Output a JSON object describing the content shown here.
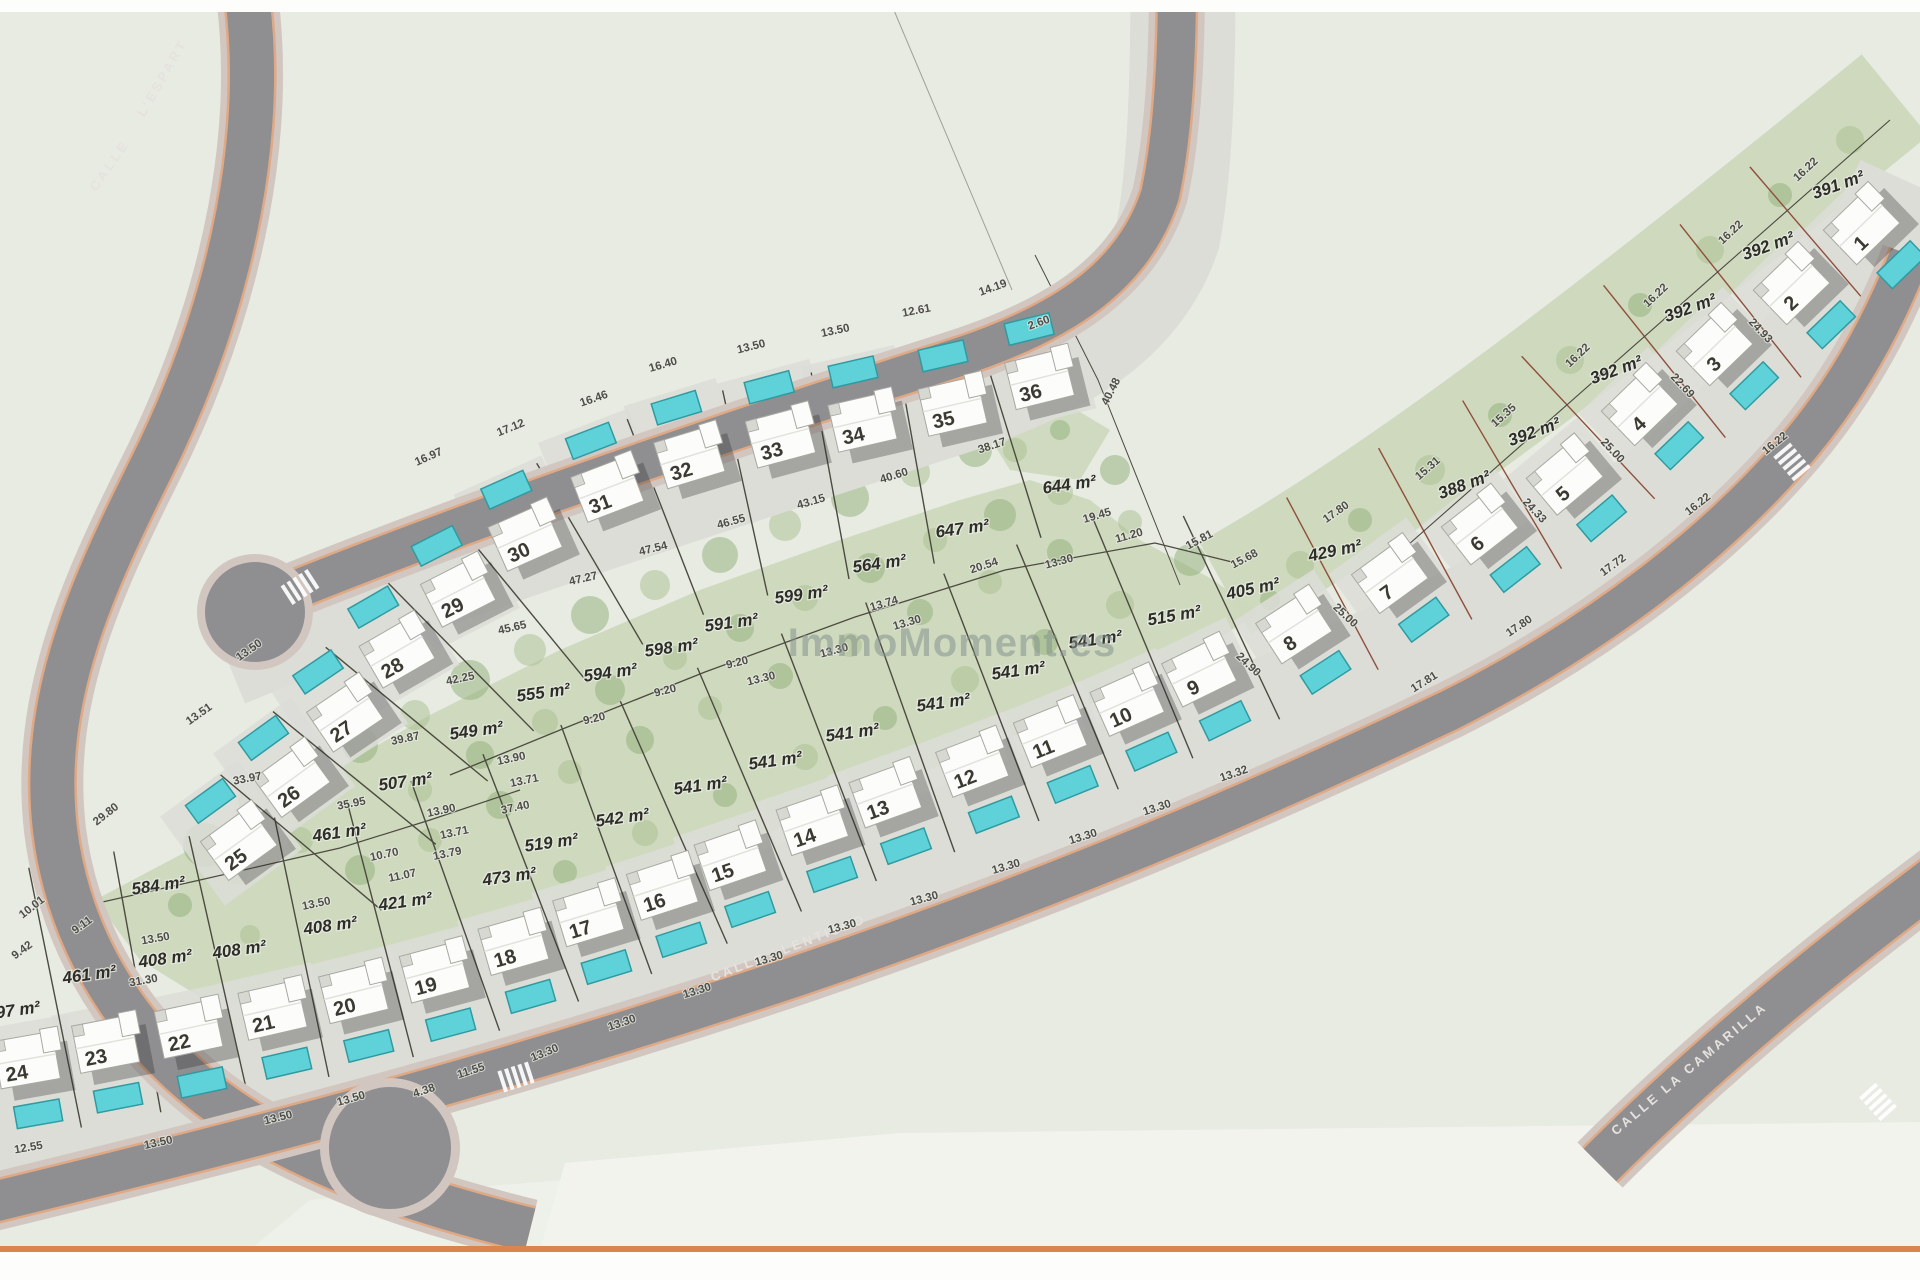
{
  "watermark": "ImmoMoment.es",
  "colors": {
    "page": "#fdfdfb",
    "field": "#e7ebe2",
    "light_zone": "#f1f3ec",
    "garden": "#ccd8bc",
    "tree1": "#a9c08f",
    "tree2": "#8fb077",
    "pavement": "#dcddd7",
    "asphalt": "#8f8e91",
    "sidewalk": "#d2c6c0",
    "curb": "#e2a176",
    "pool": "#5ed2d8",
    "pool_border": "#2f9ba1",
    "house": "#fcfcfa",
    "house_border": "#a8a8a2",
    "line_dark": "#4c4b40",
    "line_red": "#8f4f3c",
    "dim_text": "#4e4d48",
    "area_text": "#2e2d28",
    "num_text": "#3a3932",
    "watermark": "#87938e",
    "road_text": "#e6e2de",
    "orange_bar": "#d8854e"
  },
  "road_labels": [
    {
      "t": "CALLE",
      "x": 113,
      "y": 168,
      "r": -55
    },
    {
      "t": "L'ESPART",
      "x": 166,
      "y": 80,
      "r": -60
    },
    {
      "t": "CALLE LLENTISCO",
      "x": 790,
      "y": 952,
      "r": -21
    },
    {
      "t": "CALLE LA CAMARILLA",
      "x": 1692,
      "y": 1072,
      "r": -40
    }
  ],
  "plots": [
    {
      "n": "1",
      "x": 1845,
      "y": 242,
      "r": -44,
      "pool": "S"
    },
    {
      "n": "2",
      "x": 1775,
      "y": 302,
      "r": -44,
      "pool": "S"
    },
    {
      "n": "3",
      "x": 1698,
      "y": 363,
      "r": -44,
      "pool": "S"
    },
    {
      "n": "4",
      "x": 1623,
      "y": 423,
      "r": -44,
      "pool": "S"
    },
    {
      "n": "5",
      "x": 1548,
      "y": 493,
      "r": -40,
      "pool": "S"
    },
    {
      "n": "6",
      "x": 1463,
      "y": 543,
      "r": -38,
      "pool": "S"
    },
    {
      "n": "7",
      "x": 1373,
      "y": 592,
      "r": -36,
      "pool": "S"
    },
    {
      "n": "8",
      "x": 1277,
      "y": 643,
      "r": -33,
      "pool": "S"
    },
    {
      "n": "9",
      "x": 1182,
      "y": 688,
      "r": -26,
      "pool": "S"
    },
    {
      "n": "10",
      "x": 1110,
      "y": 718,
      "r": -24,
      "pool": "S"
    },
    {
      "n": "11",
      "x": 1033,
      "y": 750,
      "r": -22,
      "pool": "S"
    },
    {
      "n": "12",
      "x": 955,
      "y": 780,
      "r": -21,
      "pool": "S"
    },
    {
      "n": "13",
      "x": 868,
      "y": 811,
      "r": -20,
      "pool": "S"
    },
    {
      "n": "14",
      "x": 795,
      "y": 839,
      "r": -19,
      "pool": "S"
    },
    {
      "n": "15",
      "x": 713,
      "y": 874,
      "r": -19,
      "pool": "S"
    },
    {
      "n": "16",
      "x": 645,
      "y": 904,
      "r": -18,
      "pool": "S"
    },
    {
      "n": "17",
      "x": 571,
      "y": 931,
      "r": -17,
      "pool": "S"
    },
    {
      "n": "18",
      "x": 496,
      "y": 960,
      "r": -16,
      "pool": "S"
    },
    {
      "n": "19",
      "x": 417,
      "y": 988,
      "r": -15,
      "pool": "S"
    },
    {
      "n": "20",
      "x": 336,
      "y": 1009,
      "r": -14,
      "pool": "S"
    },
    {
      "n": "21",
      "x": 255,
      "y": 1026,
      "r": -13,
      "pool": "S"
    },
    {
      "n": "22",
      "x": 171,
      "y": 1045,
      "r": -12,
      "pool": "S"
    },
    {
      "n": "23",
      "x": 88,
      "y": 1060,
      "r": -11,
      "pool": "S"
    },
    {
      "n": "24",
      "x": 9,
      "y": 1076,
      "r": -10,
      "pool": "S"
    },
    {
      "n": "25",
      "x": 222,
      "y": 859,
      "r": -36,
      "pool": "N"
    },
    {
      "n": "26",
      "x": 275,
      "y": 796,
      "r": -36,
      "pool": "N"
    },
    {
      "n": "27",
      "x": 328,
      "y": 731,
      "r": -34,
      "pool": "N"
    },
    {
      "n": "28",
      "x": 380,
      "y": 668,
      "r": -30,
      "pool": "N"
    },
    {
      "n": "29",
      "x": 441,
      "y": 608,
      "r": -27,
      "pool": "N"
    },
    {
      "n": "30",
      "x": 508,
      "y": 553,
      "r": -24,
      "pool": "N"
    },
    {
      "n": "31",
      "x": 590,
      "y": 505,
      "r": -21,
      "pool": "N"
    },
    {
      "n": "32",
      "x": 672,
      "y": 473,
      "r": -17,
      "pool": "N"
    },
    {
      "n": "33",
      "x": 763,
      "y": 453,
      "r": -15,
      "pool": "N"
    },
    {
      "n": "34",
      "x": 845,
      "y": 438,
      "r": -13,
      "pool": "N"
    },
    {
      "n": "35",
      "x": 935,
      "y": 422,
      "r": -13,
      "pool": "N"
    },
    {
      "n": "36",
      "x": 1022,
      "y": 395,
      "r": -14,
      "pool": "N"
    }
  ],
  "area_labels": [
    {
      "t": "391 m²",
      "x": 1840,
      "y": 190,
      "r": -20
    },
    {
      "t": "392 m²",
      "x": 1770,
      "y": 251,
      "r": -20
    },
    {
      "t": "392 m²",
      "x": 1692,
      "y": 313,
      "r": -20
    },
    {
      "t": "392 m²",
      "x": 1618,
      "y": 375,
      "r": -20
    },
    {
      "t": "392 m²",
      "x": 1536,
      "y": 437,
      "r": -20
    },
    {
      "t": "388 m²",
      "x": 1466,
      "y": 490,
      "r": -20
    },
    {
      "t": "429 m²",
      "x": 1336,
      "y": 556,
      "r": -12
    },
    {
      "t": "405 m²",
      "x": 1254,
      "y": 594,
      "r": -12
    },
    {
      "t": "515 m²",
      "x": 1175,
      "y": 621,
      "r": -10
    },
    {
      "t": "541 m²",
      "x": 1096,
      "y": 645,
      "r": -8
    },
    {
      "t": "541 m²",
      "x": 1019,
      "y": 676,
      "r": -8
    },
    {
      "t": "541 m²",
      "x": 944,
      "y": 708,
      "r": -8
    },
    {
      "t": "541 m²",
      "x": 853,
      "y": 738,
      "r": -8
    },
    {
      "t": "541 m²",
      "x": 776,
      "y": 766,
      "r": -8
    },
    {
      "t": "541 m²",
      "x": 701,
      "y": 791,
      "r": -8
    },
    {
      "t": "542 m²",
      "x": 623,
      "y": 823,
      "r": -8
    },
    {
      "t": "519 m²",
      "x": 552,
      "y": 848,
      "r": -8
    },
    {
      "t": "473 m²",
      "x": 510,
      "y": 882,
      "r": -8
    },
    {
      "t": "421 m²",
      "x": 406,
      "y": 907,
      "r": -8
    },
    {
      "t": "408 m²",
      "x": 331,
      "y": 931,
      "r": -8
    },
    {
      "t": "408 m²",
      "x": 240,
      "y": 955,
      "r": -8
    },
    {
      "t": "408 m²",
      "x": 166,
      "y": 964,
      "r": -8
    },
    {
      "t": "461 m²",
      "x": 90,
      "y": 980,
      "r": -8
    },
    {
      "t": "397 m²",
      "x": 14,
      "y": 1016,
      "r": -8
    },
    {
      "t": "584 m²",
      "x": 159,
      "y": 891,
      "r": -8
    },
    {
      "t": "461 m²",
      "x": 340,
      "y": 838,
      "r": -8
    },
    {
      "t": "507 m²",
      "x": 406,
      "y": 787,
      "r": -8
    },
    {
      "t": "549 m²",
      "x": 477,
      "y": 736,
      "r": -8
    },
    {
      "t": "555 m²",
      "x": 544,
      "y": 698,
      "r": -8
    },
    {
      "t": "594 m²",
      "x": 611,
      "y": 678,
      "r": -8
    },
    {
      "t": "598 m²",
      "x": 672,
      "y": 653,
      "r": -8
    },
    {
      "t": "591 m²",
      "x": 732,
      "y": 628,
      "r": -8
    },
    {
      "t": "599 m²",
      "x": 802,
      "y": 600,
      "r": -8
    },
    {
      "t": "564 m²",
      "x": 880,
      "y": 569,
      "r": -8
    },
    {
      "t": "647 m²",
      "x": 963,
      "y": 534,
      "r": -8
    },
    {
      "t": "644 m²",
      "x": 1070,
      "y": 490,
      "r": -8
    }
  ],
  "dim_labels": [
    {
      "t": "16.97",
      "x": 430,
      "y": 460,
      "r": -24
    },
    {
      "t": "17.12",
      "x": 512,
      "y": 431,
      "r": -22
    },
    {
      "t": "16.46",
      "x": 595,
      "y": 402,
      "r": -19
    },
    {
      "t": "16.40",
      "x": 664,
      "y": 368,
      "r": -16
    },
    {
      "t": "13.50",
      "x": 752,
      "y": 350,
      "r": -14
    },
    {
      "t": "13.50",
      "x": 836,
      "y": 334,
      "r": -12
    },
    {
      "t": "12.61",
      "x": 917,
      "y": 314,
      "r": -11
    },
    {
      "t": "14.19",
      "x": 994,
      "y": 291,
      "r": -20
    },
    {
      "t": "13.50",
      "x": 251,
      "y": 653,
      "r": -35
    },
    {
      "t": "13.51",
      "x": 201,
      "y": 717,
      "r": -35
    },
    {
      "t": "29.80",
      "x": 108,
      "y": 817,
      "r": -38
    },
    {
      "t": "10.01",
      "x": 34,
      "y": 910,
      "r": -38
    },
    {
      "t": "9.11",
      "x": 84,
      "y": 928,
      "r": -36
    },
    {
      "t": "9.42",
      "x": 24,
      "y": 953,
      "r": -36
    },
    {
      "t": "13.50",
      "x": 317,
      "y": 907,
      "r": -12
    },
    {
      "t": "13.50",
      "x": 156,
      "y": 942,
      "r": -10
    },
    {
      "t": "31.30",
      "x": 144,
      "y": 984,
      "r": -10
    },
    {
      "t": "12.55",
      "x": 29,
      "y": 1151,
      "r": -10
    },
    {
      "t": "13.50",
      "x": 159,
      "y": 1146,
      "r": -12
    },
    {
      "t": "13.50",
      "x": 279,
      "y": 1121,
      "r": -14
    },
    {
      "t": "13.50",
      "x": 352,
      "y": 1102,
      "r": -16
    },
    {
      "t": "11.55",
      "x": 472,
      "y": 1074,
      "r": -18
    },
    {
      "t": "4.38",
      "x": 425,
      "y": 1094,
      "r": -18
    },
    {
      "t": "13.30",
      "x": 546,
      "y": 1056,
      "r": -22
    },
    {
      "t": "13.30",
      "x": 623,
      "y": 1026,
      "r": -19
    },
    {
      "t": "13.30",
      "x": 698,
      "y": 994,
      "r": -17
    },
    {
      "t": "13.30",
      "x": 770,
      "y": 962,
      "r": -16
    },
    {
      "t": "13.30",
      "x": 843,
      "y": 930,
      "r": -15
    },
    {
      "t": "13.30",
      "x": 925,
      "y": 902,
      "r": -15
    },
    {
      "t": "13.30",
      "x": 1007,
      "y": 870,
      "r": -16
    },
    {
      "t": "13.30",
      "x": 1084,
      "y": 840,
      "r": -17
    },
    {
      "t": "13.30",
      "x": 1158,
      "y": 811,
      "r": -18
    },
    {
      "t": "13.32",
      "x": 1235,
      "y": 777,
      "r": -19
    },
    {
      "t": "17.81",
      "x": 1426,
      "y": 685,
      "r": -32
    },
    {
      "t": "17.80",
      "x": 1521,
      "y": 629,
      "r": -34
    },
    {
      "t": "17.72",
      "x": 1615,
      "y": 568,
      "r": -36
    },
    {
      "t": "16.22",
      "x": 1700,
      "y": 507,
      "r": -38
    },
    {
      "t": "16.22",
      "x": 1777,
      "y": 446,
      "r": -39
    },
    {
      "t": "16.22",
      "x": 1808,
      "y": 172,
      "r": -43
    },
    {
      "t": "16.22",
      "x": 1733,
      "y": 235,
      "r": -43
    },
    {
      "t": "16.22",
      "x": 1658,
      "y": 298,
      "r": -43
    },
    {
      "t": "16.22",
      "x": 1580,
      "y": 358,
      "r": -43
    },
    {
      "t": "15.35",
      "x": 1506,
      "y": 418,
      "r": -42
    },
    {
      "t": "15.31",
      "x": 1430,
      "y": 471,
      "r": -41
    },
    {
      "t": "24.93",
      "x": 1758,
      "y": 333,
      "r": 47
    },
    {
      "t": "22.69",
      "x": 1680,
      "y": 388,
      "r": 47
    },
    {
      "t": "25.00",
      "x": 1610,
      "y": 453,
      "r": 47
    },
    {
      "t": "24.33",
      "x": 1532,
      "y": 513,
      "r": 47
    },
    {
      "t": "25.00",
      "x": 1343,
      "y": 618,
      "r": 43
    },
    {
      "t": "24.90",
      "x": 1246,
      "y": 667,
      "r": 43
    },
    {
      "t": "17.80",
      "x": 1338,
      "y": 515,
      "r": -35
    },
    {
      "t": "40.48",
      "x": 1114,
      "y": 393,
      "r": -63
    },
    {
      "t": "2.60",
      "x": 1040,
      "y": 326,
      "r": -20
    },
    {
      "t": "19.45",
      "x": 1098,
      "y": 519,
      "r": -16
    },
    {
      "t": "11.20",
      "x": 1130,
      "y": 539,
      "r": -16
    },
    {
      "t": "13.30",
      "x": 1060,
      "y": 565,
      "r": -15
    },
    {
      "t": "15.81",
      "x": 1201,
      "y": 543,
      "r": -28
    },
    {
      "t": "15.68",
      "x": 1246,
      "y": 562,
      "r": -28
    },
    {
      "t": "20.54",
      "x": 985,
      "y": 569,
      "r": -18
    },
    {
      "t": "13.74",
      "x": 885,
      "y": 607,
      "r": -16
    },
    {
      "t": "13.30",
      "x": 908,
      "y": 626,
      "r": -16
    },
    {
      "t": "13.30",
      "x": 835,
      "y": 654,
      "r": -15
    },
    {
      "t": "13.30",
      "x": 762,
      "y": 682,
      "r": -14
    },
    {
      "t": "9.20",
      "x": 738,
      "y": 666,
      "r": -14
    },
    {
      "t": "9.20",
      "x": 666,
      "y": 694,
      "r": -14
    },
    {
      "t": "9.20",
      "x": 595,
      "y": 722,
      "r": -13
    },
    {
      "t": "38.17",
      "x": 993,
      "y": 449,
      "r": -18
    },
    {
      "t": "40.60",
      "x": 895,
      "y": 479,
      "r": -17
    },
    {
      "t": "43.15",
      "x": 812,
      "y": 505,
      "r": -16
    },
    {
      "t": "46.55",
      "x": 732,
      "y": 525,
      "r": -15
    },
    {
      "t": "47.54",
      "x": 654,
      "y": 552,
      "r": -14
    },
    {
      "t": "47.27",
      "x": 584,
      "y": 582,
      "r": -13
    },
    {
      "t": "45.65",
      "x": 513,
      "y": 631,
      "r": -13
    },
    {
      "t": "42.25",
      "x": 461,
      "y": 682,
      "r": -12
    },
    {
      "t": "39.87",
      "x": 406,
      "y": 742,
      "r": -12
    },
    {
      "t": "35.95",
      "x": 352,
      "y": 807,
      "r": -11
    },
    {
      "t": "33.97",
      "x": 248,
      "y": 782,
      "r": -11
    },
    {
      "t": "13.90",
      "x": 512,
      "y": 762,
      "r": -12
    },
    {
      "t": "13.71",
      "x": 525,
      "y": 784,
      "r": -12
    },
    {
      "t": "37.40",
      "x": 516,
      "y": 811,
      "r": -12
    },
    {
      "t": "13.90",
      "x": 442,
      "y": 814,
      "r": -12
    },
    {
      "t": "13.71",
      "x": 455,
      "y": 836,
      "r": -12
    },
    {
      "t": "13.79",
      "x": 448,
      "y": 857,
      "r": -12
    },
    {
      "t": "10.70",
      "x": 385,
      "y": 858,
      "r": -12
    },
    {
      "t": "11.07",
      "x": 403,
      "y": 879,
      "r": -12
    }
  ]
}
